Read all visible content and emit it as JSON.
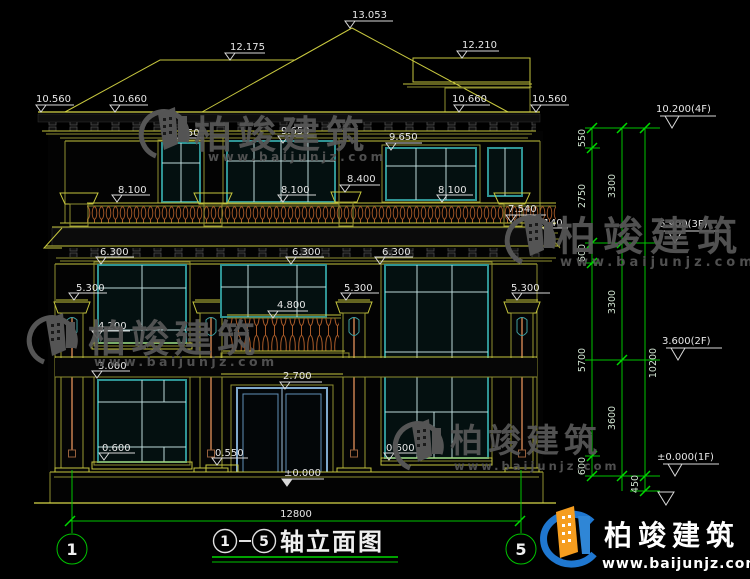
{
  "watermark": {
    "brand": "柏竣建筑",
    "url": "www.baijunjz.com"
  },
  "logo": {
    "brand": "柏竣建筑",
    "url": "www.baijunjz.com"
  },
  "drawing": {
    "title": {
      "axis_start": "1",
      "axis_end": "5",
      "text": "轴立面图"
    },
    "axis_bubbles": {
      "left": "1",
      "right": "5"
    },
    "bottom_dim": "12800",
    "levels": {
      "ridge": "13.053",
      "ridge_left": "12.175",
      "ridge_right": "12.210",
      "eave_far_left": "10.560",
      "eave_left": "10.660",
      "eave_right": "10.660",
      "eave_far_right": "10.560",
      "win3_left": "9.650",
      "win3_mid": "9.650",
      "win3_right": "9.650",
      "rail3_left": "8.100",
      "rail3_mid": "8.100",
      "rail3_right": "8.100",
      "pedestal3": "8.400",
      "rail3_bottom": "7.540",
      "skirt_edge": "7.140",
      "win2_left": "6.300",
      "win2_mid": "6.300",
      "win2_right": "6.300",
      "cap_left": "5.300",
      "cap_mid": "5.300",
      "cap_right": "5.300",
      "balcony_rail": "4.800",
      "win2_sill": "4.200",
      "win1_top": "3.000",
      "door_top": "2.700",
      "sill_left": "0.600",
      "porch_ledge": "0.550",
      "entry_floor": "±0.000",
      "sill_right": "0.600"
    },
    "right_chain": {
      "floor_levels": [
        "10.200(4F)",
        "6.900(3F)",
        "3.600(2F)",
        "±0.000(1F)"
      ],
      "inner": [
        "550",
        "2750",
        "600",
        "5700",
        "600"
      ],
      "middle": [
        "3300",
        "3300",
        "3600"
      ],
      "total": "10200",
      "base": "450"
    }
  }
}
